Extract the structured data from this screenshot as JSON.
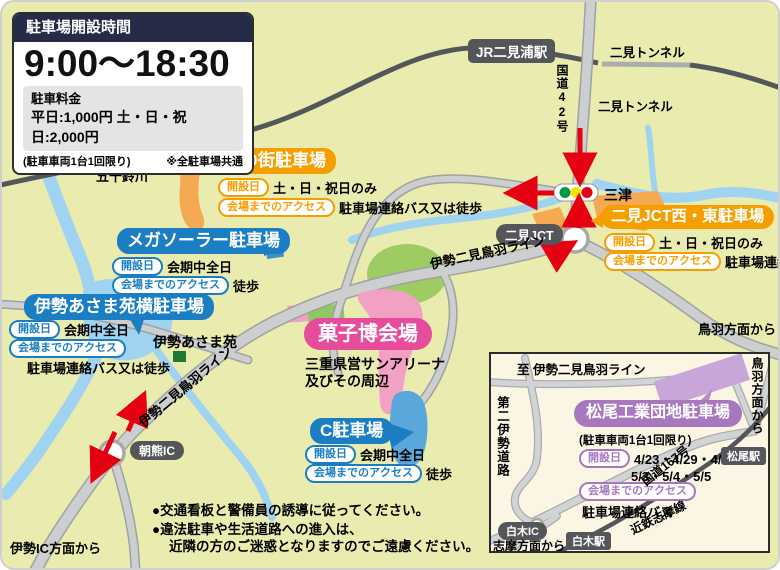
{
  "info_box": {
    "title": "駐車場開設時間",
    "hours": "9:00〜18:30",
    "fee_label": "駐車料金",
    "fee_text": "平日:1,000円  土・日・祝日:2,000円",
    "note_left": "(駐車車両1台1回限り)",
    "note_right": "※全駐車場共通"
  },
  "pills": {
    "open": "開設日",
    "access": "会場までのアクセス"
  },
  "venue": {
    "name": "菓子博会場",
    "desc_line1": "三重県営サンアリーナ",
    "desc_line2": "及びその周辺"
  },
  "parkings": [
    {
      "name": "光の街駐車場",
      "open": "土・日・祝日のみ",
      "access": "駐車場連絡バス又は徒歩"
    },
    {
      "name": "メガソーラー駐車場",
      "open": "会期中全日",
      "access": "徒歩"
    },
    {
      "name": "伊勢あさま苑横駐車場",
      "open": "会期中全日",
      "access": "駐車場連絡バス又は徒歩"
    },
    {
      "name": "二見JCT西・東駐車場",
      "open": "土・日・祝日のみ",
      "access": "駐車場連絡バス"
    },
    {
      "name": "C駐車場",
      "open": "会期中全日",
      "access": "徒歩"
    },
    {
      "name": "松尾工業団地駐車場",
      "limit": "(駐車車両1台1回限り)",
      "open_line1": "4/23・4/29・4/30",
      "open_line2": "5/3・5/4・5/5",
      "access": "駐車場連絡バス"
    }
  ],
  "map_labels": {
    "jr_station": "JR二見浦駅",
    "tunnel_rail": "二見トンネル",
    "tunnel_road": "二見トンネル",
    "route42": "国道42号",
    "mitsu": "三津",
    "futami_jct": "二見JCT",
    "isuzu_river": "五十鈴川",
    "toba_line_1": "伊勢二見鳥羽ライン",
    "toba_line_2": "伊勢二見鳥羽ライン",
    "asamaen": "伊勢あさま苑",
    "asama_ic": "朝熊IC",
    "from_toba": "鳥羽方面から",
    "from_ise_ic": "伊勢IC方面から"
  },
  "inset": {
    "to_toba_line": "至 伊勢二見鳥羽ライン",
    "from_toba_vertical": "鳥羽方面から",
    "daini_ise_road": "第二伊勢道路",
    "route167": "国道167号",
    "kintetsu_shima_line": "近鉄志摩線",
    "shiraki_ic": "白木IC",
    "shiraki_station": "白木駅",
    "matsuo_station": "松尾駅",
    "from_shima": "志摩方面から"
  },
  "notes": [
    "●交通看板と警備員の誘導に従ってください。",
    "●違法駐車や生活道路への進入は、",
    "近隣の方のご迷惑となりますのでご遠慮ください。"
  ],
  "colors": {
    "orange": "#F59E00",
    "blue": "#1B7EC2",
    "pink": "#E74C9C",
    "purple": "#A878BE",
    "red": "#E50012",
    "dark_gray": "#54565A",
    "map_bg": "#E9ECAE",
    "river": "#A0D3F1"
  }
}
